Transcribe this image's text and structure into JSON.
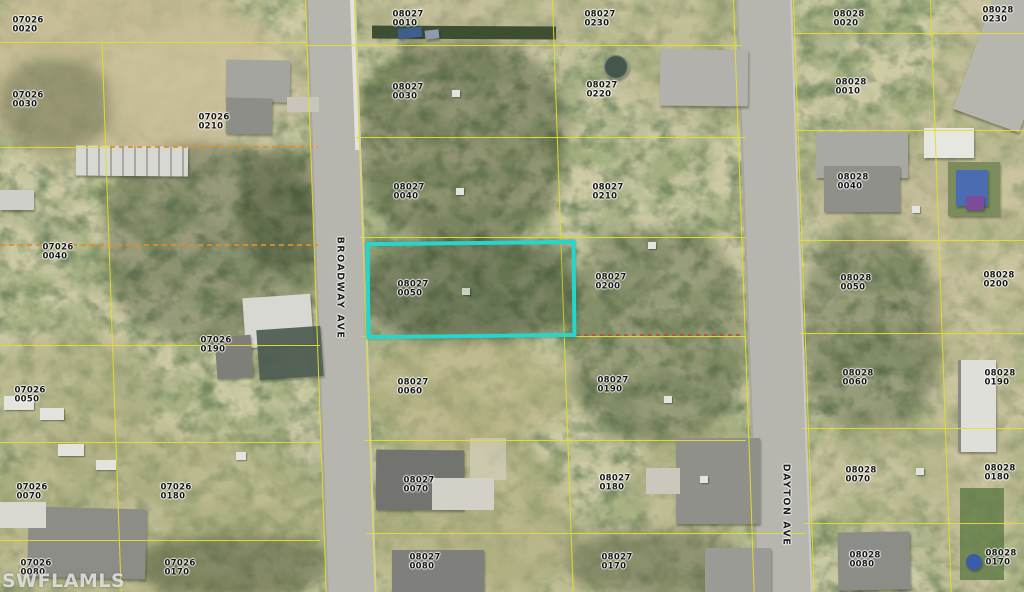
{
  "watermark": "SWFLAMLS",
  "subject_parcel": "08027 0050",
  "colors": {
    "parcel_boundary": "#e3dd2f",
    "subject_highlight": "#25d6cd",
    "label_text": "#141414"
  },
  "streets": [
    {
      "name": "BROADWAY AVE",
      "x": 340,
      "y": 288
    },
    {
      "name": "DAYTON AVE",
      "x": 786,
      "y": 505
    }
  ],
  "parcels": [
    {
      "block": "07026",
      "lot": "0020",
      "x": 28,
      "y": 25
    },
    {
      "block": "07026",
      "lot": "0030",
      "x": 28,
      "y": 100
    },
    {
      "block": "07026",
      "lot": "0210",
      "x": 214,
      "y": 122
    },
    {
      "block": "07026",
      "lot": "0040",
      "x": 58,
      "y": 252
    },
    {
      "block": "07026",
      "lot": "0190",
      "x": 216,
      "y": 345
    },
    {
      "block": "07026",
      "lot": "0050",
      "x": 30,
      "y": 395
    },
    {
      "block": "07026",
      "lot": "0070",
      "x": 32,
      "y": 492
    },
    {
      "block": "07026",
      "lot": "0180",
      "x": 176,
      "y": 492
    },
    {
      "block": "07026",
      "lot": "0080",
      "x": 36,
      "y": 568
    },
    {
      "block": "07026",
      "lot": "0170",
      "x": 180,
      "y": 568
    },
    {
      "block": "08027",
      "lot": "0010",
      "x": 408,
      "y": 19
    },
    {
      "block": "08027",
      "lot": "0230",
      "x": 600,
      "y": 19
    },
    {
      "block": "08027",
      "lot": "0030",
      "x": 408,
      "y": 92
    },
    {
      "block": "08027",
      "lot": "0220",
      "x": 602,
      "y": 90
    },
    {
      "block": "08027",
      "lot": "0040",
      "x": 409,
      "y": 192
    },
    {
      "block": "08027",
      "lot": "0210",
      "x": 608,
      "y": 192
    },
    {
      "block": "08027",
      "lot": "0050",
      "x": 413,
      "y": 289,
      "subject": true
    },
    {
      "block": "08027",
      "lot": "0200",
      "x": 611,
      "y": 282
    },
    {
      "block": "08027",
      "lot": "0060",
      "x": 413,
      "y": 387
    },
    {
      "block": "08027",
      "lot": "0190",
      "x": 613,
      "y": 385
    },
    {
      "block": "08027",
      "lot": "0070",
      "x": 419,
      "y": 485
    },
    {
      "block": "08027",
      "lot": "0180",
      "x": 615,
      "y": 483
    },
    {
      "block": "08027",
      "lot": "0080",
      "x": 425,
      "y": 562
    },
    {
      "block": "08027",
      "lot": "0170",
      "x": 617,
      "y": 562
    },
    {
      "block": "08028",
      "lot": "0020",
      "x": 849,
      "y": 19
    },
    {
      "block": "08028",
      "lot": "0230",
      "x": 998,
      "y": 15
    },
    {
      "block": "08028",
      "lot": "0010",
      "x": 851,
      "y": 87
    },
    {
      "block": "08028",
      "lot": "0040",
      "x": 853,
      "y": 182
    },
    {
      "block": "08028",
      "lot": "0050",
      "x": 856,
      "y": 283
    },
    {
      "block": "08028",
      "lot": "0200",
      "x": 999,
      "y": 280
    },
    {
      "block": "08028",
      "lot": "0060",
      "x": 858,
      "y": 378
    },
    {
      "block": "08028",
      "lot": "0190",
      "x": 1000,
      "y": 378
    },
    {
      "block": "08028",
      "lot": "0070",
      "x": 861,
      "y": 475
    },
    {
      "block": "08028",
      "lot": "0180",
      "x": 1000,
      "y": 473
    },
    {
      "block": "08028",
      "lot": "0080",
      "x": 865,
      "y": 560
    },
    {
      "block": "08028",
      "lot": "0170",
      "x": 1001,
      "y": 558
    }
  ]
}
